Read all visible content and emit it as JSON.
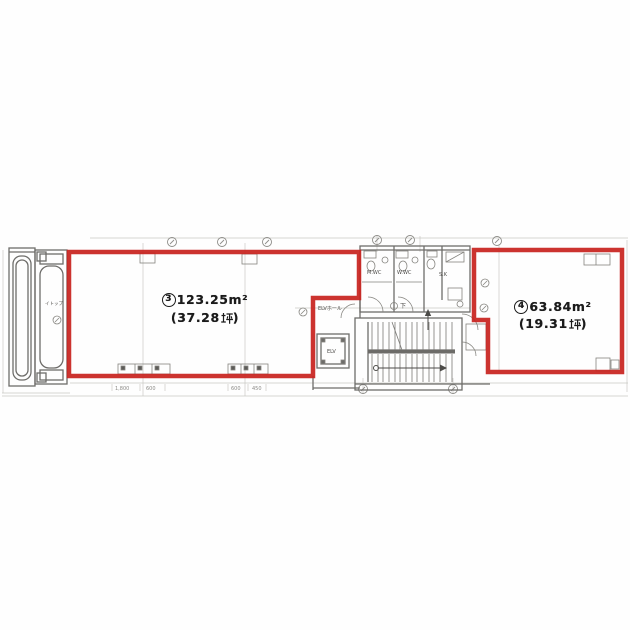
{
  "image": {
    "type": "scanned-floor-plan"
  },
  "colors": {
    "red_outline": "#c8231f",
    "wall_line": "#6e6d6a",
    "fixture_line": "#85847f",
    "faint_grid": "#c4c3be",
    "label_text": "#1b1b1b"
  },
  "rooms": [
    {
      "number": "3",
      "area": "123.25m²",
      "area_full": "③123.25㎡",
      "tsubo_open": "(37.28",
      "tsubo_close": ")",
      "tsubo_full": "（37.28坪）"
    },
    {
      "number": "4",
      "area": "63.84m²",
      "area_full": "④63.84㎡",
      "tsubo_open": "(19.31",
      "tsubo_close": ")",
      "tsubo_full": "（19.31坪）"
    }
  ],
  "labels": {
    "elv_hall": "ELVホール",
    "elv": "ELV",
    "mwc": "M.WC",
    "wwc": "W.WC",
    "sk": "S.K",
    "down": "下",
    "shaft": "イトップ"
  },
  "dimensions": {
    "left1": "1,800",
    "left2": "600",
    "mid1": "600",
    "mid2": "450"
  }
}
